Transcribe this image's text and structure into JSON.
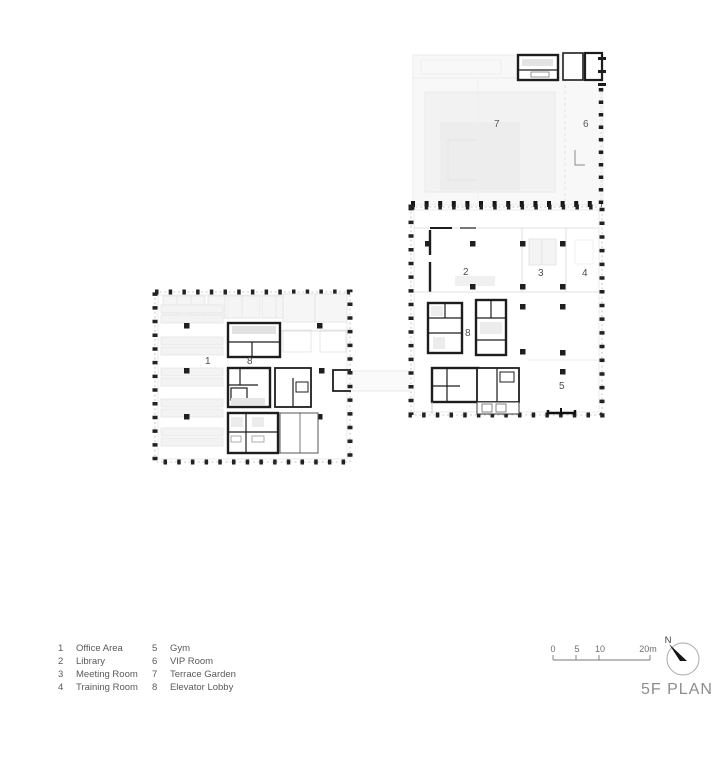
{
  "title": "5F PLAN",
  "north_label": "N",
  "scale_bar": {
    "ticks": [
      "0",
      "5",
      "10",
      "20m"
    ]
  },
  "legend": {
    "items": [
      {
        "num": "1",
        "label": "Office Area"
      },
      {
        "num": "2",
        "label": "Library"
      },
      {
        "num": "3",
        "label": "Meeting Room"
      },
      {
        "num": "4",
        "label": "Training Room"
      },
      {
        "num": "5",
        "label": "Gym"
      },
      {
        "num": "6",
        "label": "VIP Room"
      },
      {
        "num": "7",
        "label": "Terrace Garden"
      },
      {
        "num": "8",
        "label": "Elevator Lobby"
      }
    ]
  },
  "plan": {
    "room_labels": {
      "office_area": "1",
      "library": "2",
      "meeting_room": "3",
      "training_room": "4",
      "gym": "5",
      "vip_room": "6",
      "terrace_garden": "7",
      "elevator_lobby_left": "8",
      "elevator_lobby_right": "8"
    }
  },
  "colors": {
    "wall": "#1d1d1d",
    "perimeter_dash": "#b8b8b8",
    "ghost_line": "#e7e7e7",
    "label_text": "#4c4c4c",
    "title_text": "#8d8d8d"
  }
}
